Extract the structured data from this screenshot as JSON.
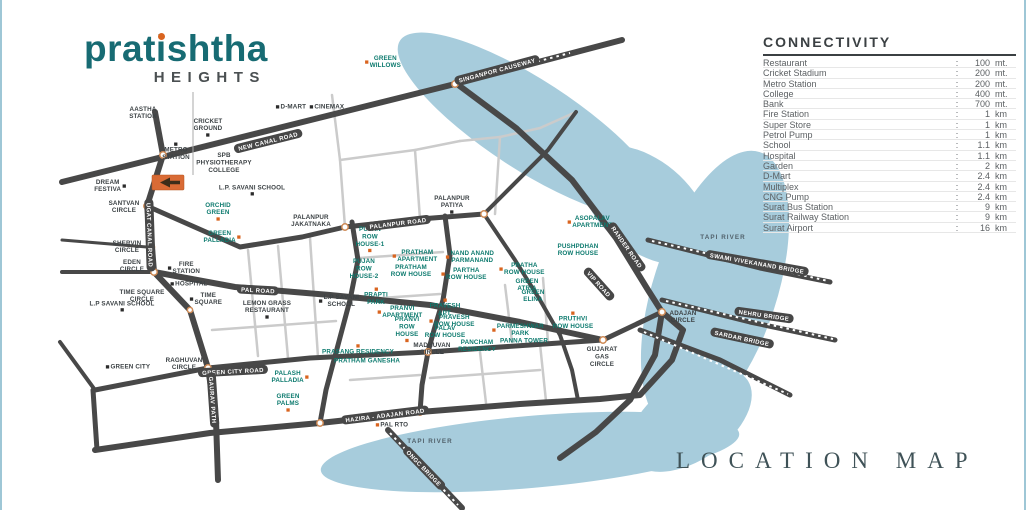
{
  "colors": {
    "teal": "#176b73",
    "orange": "#d9641f",
    "river": "#a7ccdc",
    "road_main": "#484848",
    "road_minor": "#cbcbcb",
    "label_dark": "#3c4245",
    "label_teal": "#0c7a6e"
  },
  "logo": {
    "name_pre": "prat",
    "name_i": "i",
    "name_post": "shtha",
    "tagline": "HEIGHTS"
  },
  "connectivity": {
    "title": "CONNECTIVITY",
    "separator": ":",
    "rows": [
      [
        "Restaurant",
        "100",
        "mt."
      ],
      [
        "Cricket Stadium",
        "200",
        "mt."
      ],
      [
        "Metro Station",
        "200",
        "mt."
      ],
      [
        "College",
        "400",
        "mt."
      ],
      [
        "Bank",
        "700",
        "mt."
      ],
      [
        "Fire Station",
        "1",
        "km"
      ],
      [
        "Super Store",
        "1",
        "km"
      ],
      [
        "Petrol Pump",
        "1",
        "km"
      ],
      [
        "School",
        "1.1",
        "km"
      ],
      [
        "Hospital",
        "1.1",
        "km"
      ],
      [
        "Garden",
        "2",
        "km"
      ],
      [
        "D-Mart",
        "2.4",
        "km"
      ],
      [
        "Multiplex",
        "2.4",
        "km"
      ],
      [
        "CNG Pump",
        "2.4",
        "km"
      ],
      [
        "Surat Bus Station",
        "9",
        "km"
      ],
      [
        "Surat Railway Station",
        "9",
        "km"
      ],
      [
        "Surat Airport",
        "16",
        "km"
      ]
    ]
  },
  "footer": {
    "title": "LOCATION MAP"
  },
  "map": {
    "place_labels": [
      {
        "t": "AASTHA\nSTATION",
        "x": 143,
        "y": 113,
        "c": "dark"
      },
      {
        "t": "GREEN\nWILLOWS",
        "x": 383,
        "y": 62,
        "c": "teal",
        "m": "o-l"
      },
      {
        "t": "D-MART",
        "x": 291,
        "y": 107,
        "c": "dark",
        "m": "b-l"
      },
      {
        "t": "CINEMAX",
        "x": 327,
        "y": 107,
        "c": "dark",
        "m": "b-l"
      },
      {
        "t": "CRICKET\nGROUND",
        "x": 208,
        "y": 127,
        "c": "dark",
        "m": "b-b"
      },
      {
        "t": "METRO\nSTATION",
        "x": 176,
        "y": 152,
        "c": "dark",
        "m": "b-t"
      },
      {
        "t": "SPB\nPHYSIOTHERAPY\nCOLLEGE",
        "x": 224,
        "y": 163,
        "c": "dark"
      },
      {
        "t": "DREAM\nFESTIVA",
        "x": 110,
        "y": 186,
        "c": "dark",
        "m": "b-r"
      },
      {
        "t": "SANTVAN\nCIRCLE",
        "x": 124,
        "y": 207,
        "c": "dark"
      },
      {
        "t": "L.P. SAVANI SCHOOL",
        "x": 252,
        "y": 190,
        "c": "dark",
        "m": "b-b"
      },
      {
        "t": "ORCHID\nGREEN",
        "x": 218,
        "y": 211,
        "c": "teal",
        "m": "o-b"
      },
      {
        "t": "GREEN\nPALLADIA",
        "x": 222,
        "y": 237,
        "c": "teal",
        "m": "o-r"
      },
      {
        "t": "PALANPUR\nJAKATNAKA",
        "x": 311,
        "y": 221,
        "c": "dark"
      },
      {
        "t": "PALANPUR\nPATIYA",
        "x": 452,
        "y": 204,
        "c": "dark",
        "m": "b-b"
      },
      {
        "t": "SHERVIN\nCIRCLE",
        "x": 127,
        "y": 247,
        "c": "dark"
      },
      {
        "t": "EDEN\nCIRCLE",
        "x": 132,
        "y": 266,
        "c": "dark"
      },
      {
        "t": "FIRE\nSTATION",
        "x": 184,
        "y": 268,
        "c": "dark",
        "m": "b-l"
      },
      {
        "t": "TIME SQUARE\nCIRCLE",
        "x": 142,
        "y": 296,
        "c": "dark"
      },
      {
        "t": "HOSPITAL",
        "x": 189,
        "y": 284,
        "c": "dark",
        "m": "b-l"
      },
      {
        "t": "L.P SAVANI SCHOOL",
        "x": 122,
        "y": 306,
        "c": "dark",
        "m": "b-b"
      },
      {
        "t": "TIME\nSQUARE",
        "x": 206,
        "y": 299,
        "c": "dark",
        "m": "b-l"
      },
      {
        "t": "LEMON GRASS\nRESTAURANT",
        "x": 267,
        "y": 309,
        "c": "dark",
        "m": "b-b"
      },
      {
        "t": "GREEN CITY",
        "x": 128,
        "y": 367,
        "c": "dark",
        "m": "b-l"
      },
      {
        "t": "RAGHUVAN\nCIRCLE",
        "x": 184,
        "y": 364,
        "c": "dark"
      },
      {
        "t": "PALASH\nPALLADIA",
        "x": 290,
        "y": 377,
        "c": "teal",
        "m": "o-r"
      },
      {
        "t": "GREEN\nPALMS",
        "x": 288,
        "y": 402,
        "c": "teal",
        "m": "o-b"
      },
      {
        "t": "PRASANG RESIDENCY",
        "x": 358,
        "y": 350,
        "c": "teal",
        "m": "o-t"
      },
      {
        "t": "PRATHAM GANESHA",
        "x": 367,
        "y": 361,
        "c": "teal"
      },
      {
        "t": "PUJAN\nROW\nHOUSE-1",
        "x": 370,
        "y": 239,
        "c": "teal",
        "m": "o-b"
      },
      {
        "t": "PUJAN\nROW\nHOUSE-2",
        "x": 364,
        "y": 269,
        "c": "teal"
      },
      {
        "t": "PRATHAM\nAPARTMENT",
        "x": 415,
        "y": 256,
        "c": "teal",
        "m": "o-l"
      },
      {
        "t": "PRATHAM\nROW HOUSE",
        "x": 411,
        "y": 271,
        "c": "teal"
      },
      {
        "t": "NAND ANAND\nPARMANAND",
        "x": 470,
        "y": 257,
        "c": "teal",
        "m": "o-l"
      },
      {
        "t": "PARTHA\nROW HOUSE",
        "x": 464,
        "y": 274,
        "c": "teal",
        "m": "o-l"
      },
      {
        "t": "PRATHA\nROW HOUSE",
        "x": 522,
        "y": 269,
        "c": "teal",
        "m": "o-l"
      },
      {
        "t": "GREEN\nATRIA",
        "x": 527,
        "y": 285,
        "c": "teal"
      },
      {
        "t": "GREEN\nELINA",
        "x": 533,
        "y": 296,
        "c": "teal"
      },
      {
        "t": "L.P SAVANI\nSCHOOL",
        "x": 339,
        "y": 301,
        "c": "dark",
        "m": "b-l"
      },
      {
        "t": "PRAPTI\nPARK",
        "x": 376,
        "y": 297,
        "c": "teal",
        "m": "o-t"
      },
      {
        "t": "PRANVI\nAPARTMENT",
        "x": 400,
        "y": 312,
        "c": "teal",
        "m": "o-l"
      },
      {
        "t": "PRANVI\nROW\nHOUSE",
        "x": 407,
        "y": 329,
        "c": "teal",
        "m": "o-b"
      },
      {
        "t": "PRAVESH\nAPT.",
        "x": 445,
        "y": 308,
        "c": "teal",
        "m": "o-t"
      },
      {
        "t": "PRAVESH\nROW HOUSE",
        "x": 452,
        "y": 321,
        "c": "teal",
        "m": "o-l"
      },
      {
        "t": "PALAV\nROW HOUSE",
        "x": 445,
        "y": 332,
        "c": "teal"
      },
      {
        "t": "PARMESHWAR\nPARK",
        "x": 518,
        "y": 330,
        "c": "teal",
        "m": "o-l"
      },
      {
        "t": "PANNA TOWER",
        "x": 524,
        "y": 341,
        "c": "teal"
      },
      {
        "t": "PANCHAM\nRESIDENCY",
        "x": 477,
        "y": 346,
        "c": "teal"
      },
      {
        "t": "MADHUVAN\nCIRCLE",
        "x": 432,
        "y": 349,
        "c": "dark"
      },
      {
        "t": "PRUTHVI\nROW HOUSE",
        "x": 573,
        "y": 321,
        "c": "teal",
        "m": "o-t"
      },
      {
        "t": "GUJARAT\nGAS\nCIRCLE",
        "x": 602,
        "y": 357,
        "c": "dark"
      },
      {
        "t": "ADAJAN\nCIRCLE",
        "x": 683,
        "y": 317,
        "c": "dark"
      },
      {
        "t": "ASOPALAV\nAPARTMENT",
        "x": 590,
        "y": 222,
        "c": "teal",
        "m": "o-l"
      },
      {
        "t": "PUSHPDHAN\nROW HOUSE",
        "x": 578,
        "y": 250,
        "c": "teal"
      },
      {
        "t": "PAL RTO",
        "x": 392,
        "y": 425,
        "c": "dark",
        "m": "o-l"
      }
    ],
    "road_labels": [
      {
        "t": "NEW CANAL ROAD",
        "x": 268,
        "y": 141,
        "a": -14
      },
      {
        "t": "PALANPUR ROAD",
        "x": 398,
        "y": 223,
        "a": -7
      },
      {
        "t": "PAL ROAD",
        "x": 258,
        "y": 290,
        "a": 3
      },
      {
        "t": "GREEN CITY ROAD",
        "x": 233,
        "y": 371,
        "a": -3
      },
      {
        "t": "HAZIRA - ADAJAN ROAD",
        "x": 385,
        "y": 415,
        "a": -7
      },
      {
        "t": "GAURAV PATH",
        "x": 213,
        "y": 400,
        "a": 86
      },
      {
        "t": "UGAT CANAL ROAD",
        "x": 150,
        "y": 235,
        "a": 88
      },
      {
        "t": "RANDER ROAD",
        "x": 627,
        "y": 247,
        "a": 55
      },
      {
        "t": "VIP ROAD",
        "x": 599,
        "y": 284,
        "a": 48
      },
      {
        "t": "SINGANPOR CAUSEWAY",
        "x": 497,
        "y": 70,
        "a": -15
      },
      {
        "t": "SWAMI VIVEKANAND BRIDGE",
        "x": 757,
        "y": 263,
        "a": 10
      },
      {
        "t": "NEHRU BRIDGE",
        "x": 764,
        "y": 315,
        "a": 8
      },
      {
        "t": "SARDAR BRIDGE",
        "x": 742,
        "y": 338,
        "a": 12
      },
      {
        "t": "ONGC BRIDGE",
        "x": 424,
        "y": 468,
        "a": 46
      }
    ],
    "water_labels": [
      {
        "t": "TAPI RIVER",
        "x": 723,
        "y": 237
      },
      {
        "t": "TAPI RIVER",
        "x": 430,
        "y": 441
      }
    ]
  }
}
